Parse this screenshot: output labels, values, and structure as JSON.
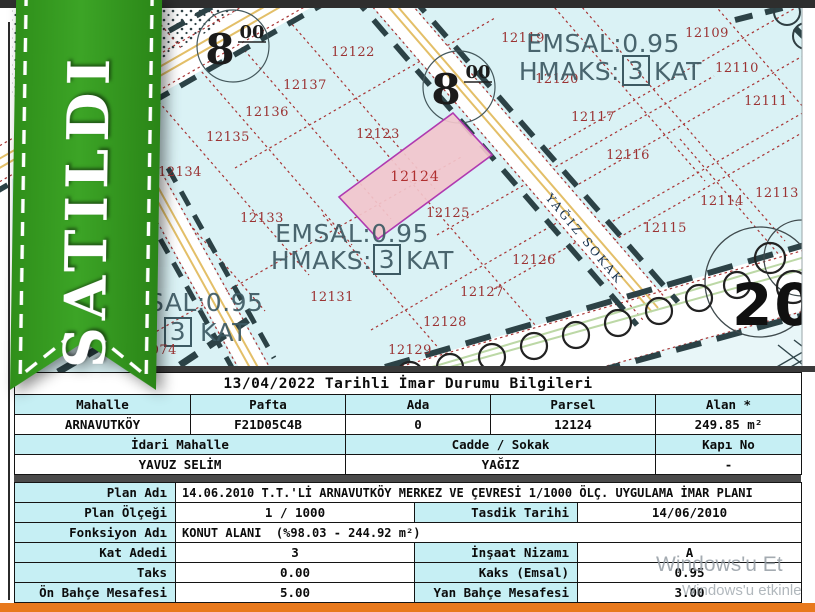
{
  "ribbon": {
    "label": "SATILDI"
  },
  "map": {
    "emsal_text": "EMSAL:0.95",
    "hmaks_prefix": "HMAKS:",
    "hmaks_floors": "3",
    "hmaks_suffix": "KAT",
    "road_width_int": "8",
    "road_width_dec": "00",
    "street": "YAĞIZ SOKAK",
    "block_no": "20",
    "partial_left": {
      "emsal": "SAL:0.95",
      "floors": "3",
      "kat": "KAT",
      "parcel": "12074"
    },
    "highlight": {
      "n": "12124",
      "x": 415,
      "y": 181
    },
    "parcels": [
      {
        "n": "12122",
        "x": 353,
        "y": 56
      },
      {
        "n": "12137",
        "x": 305,
        "y": 89
      },
      {
        "n": "12136",
        "x": 267,
        "y": 116
      },
      {
        "n": "12135",
        "x": 228,
        "y": 141
      },
      {
        "n": "12134",
        "x": 180,
        "y": 176
      },
      {
        "n": "12123",
        "x": 378,
        "y": 138
      },
      {
        "n": "12125",
        "x": 448,
        "y": 217
      },
      {
        "n": "12133",
        "x": 262,
        "y": 222
      },
      {
        "n": "12131",
        "x": 332,
        "y": 301
      },
      {
        "n": "12128",
        "x": 445,
        "y": 326
      },
      {
        "n": "12129",
        "x": 410,
        "y": 354
      },
      {
        "n": "12126",
        "x": 534,
        "y": 264
      },
      {
        "n": "12127",
        "x": 482,
        "y": 296
      },
      {
        "n": "12119",
        "x": 523,
        "y": 42
      },
      {
        "n": "12120",
        "x": 557,
        "y": 83
      },
      {
        "n": "12109",
        "x": 707,
        "y": 37
      },
      {
        "n": "12110",
        "x": 737,
        "y": 72
      },
      {
        "n": "12111",
        "x": 766,
        "y": 105
      },
      {
        "n": "12117",
        "x": 593,
        "y": 121
      },
      {
        "n": "12116",
        "x": 628,
        "y": 159
      },
      {
        "n": "12113",
        "x": 777,
        "y": 197
      },
      {
        "n": "12114",
        "x": 722,
        "y": 205
      },
      {
        "n": "12115",
        "x": 665,
        "y": 232
      }
    ]
  },
  "info_table": {
    "title": "13/04/2022 Tarihli İmar Durumu Bilgileri",
    "h_mahalle": "Mahalle",
    "h_pafta": "Pafta",
    "h_ada": "Ada",
    "h_parsel": "Parsel",
    "h_alan": "Alan *",
    "v_mahalle": "ARNAVUTKÖY",
    "v_pafta": "F21D05C4B",
    "v_ada": "0",
    "v_parsel": "12124",
    "v_alan": "249.85 m²",
    "h_idari": "İdari Mahalle",
    "h_cadde": "Cadde / Sokak",
    "h_kapi": "Kapı No",
    "v_idari": "YAVUZ SELİM",
    "v_cadde": "YAĞIZ",
    "v_kapi": "-",
    "plan_adi_label": "Plan Adı",
    "plan_adi": "14.06.2010 T.T.'Lİ ARNAVUTKÖY MERKEZ VE ÇEVRESİ 1/1000 ÖLÇ. UYGULAMA İMAR PLANI",
    "plan_olcegi_label": "Plan Ölçeği",
    "plan_olcegi": "1 / 1000",
    "tasdik_label": "Tasdik Tarihi",
    "tasdik": "14/06/2010",
    "fonksiyon_label": "Fonksiyon Adı",
    "fonksiyon": "KONUT ALANI  (%98.03 - 244.92 m²)",
    "kat_label": "Kat Adedi",
    "kat": "3",
    "nizam_label": "İnşaat Nizamı",
    "nizam": "A",
    "taks_label": "Taks",
    "taks": "0.00",
    "kaks_label": "Kaks (Emsal)",
    "kaks": "0.95",
    "on_bahce_label": "Ön Bahçe Mesafesi",
    "on_bahce": "5.00",
    "yan_bahce_label": "Yan Bahçe Mesafesi",
    "yan_bahce": "3.00"
  },
  "watermark": {
    "line1": "Windows'u Et",
    "line2": "Windows'u etkinle"
  },
  "colors": {
    "ribbon_green": "#35991f",
    "table_cyan": "#c6eff4",
    "map_cyan": "#daf2f5",
    "highlight_pink": "#f2c6cc",
    "highlight_border": "#b03ab0",
    "bottom_bar": "#e8791d"
  }
}
